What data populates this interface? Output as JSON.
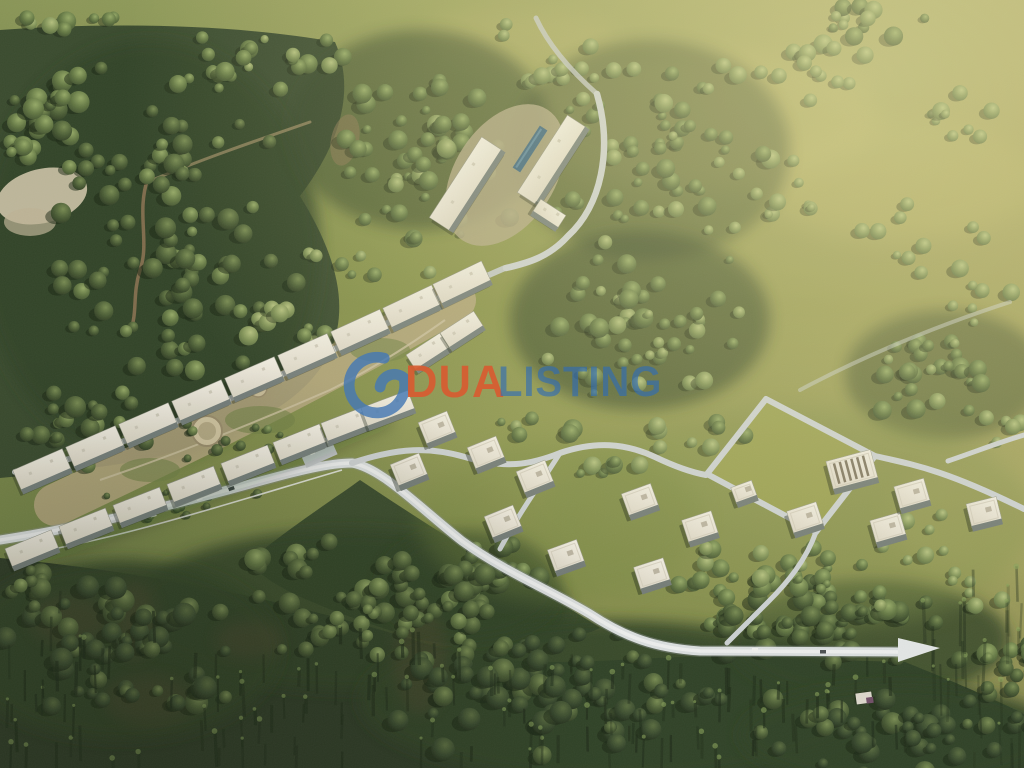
{
  "scene": {
    "title": "Aerial master-plan render of a forested hillside residential development",
    "features": {
      "townhouse_complex": "two curved rows of white terraced apartment blocks with a landscaped courtyard and circular garden",
      "clubhouse": "hilltop building cluster with lap swimming pool",
      "villa_district": "detached flat-roof villas along looping concrete roads",
      "roads": "light concrete roads winding through the site, ending in a pointed spur at lower right",
      "landscape": "dense dark pine forest below, sunlit olive meadows with scattered trees above, dirt trail in the upper-left woods"
    }
  },
  "watermark": {
    "logo_name": "dua-listing-swirl-logo",
    "word1": "DUA",
    "word2": "LISTING",
    "word1_color": "#D85C31",
    "word2_color": "#2E6CB8",
    "logo_color": "#4679B4"
  },
  "palette": {
    "meadow_light": "#a3a05c",
    "meadow": "#889149",
    "meadow_dark": "#6f8040",
    "forest": "#33452a",
    "forest_deep": "#273522",
    "road": "#ccd1d5",
    "road_bright": "#e9ebec",
    "roof": "#f3efe6",
    "roof_shade": "#ddd7c8",
    "facade": "#717b7a",
    "pool": "#35617f",
    "courtyard": "#b5a67f",
    "sand": "#cdc3a8",
    "dirt": "#8b7050"
  }
}
